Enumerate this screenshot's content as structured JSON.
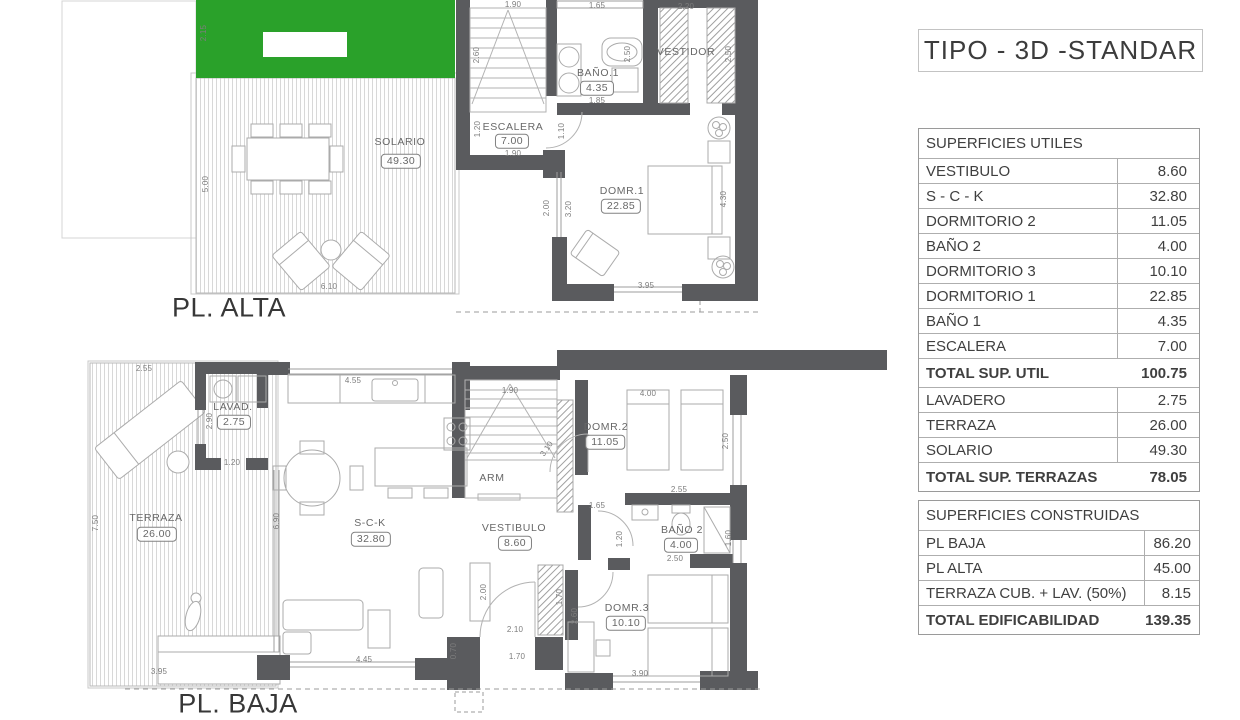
{
  "title": "TIPO - 3D -STANDAR",
  "plans": {
    "alta": {
      "annotations": [
        {
          "kind": "title",
          "text": "PL. ALTA",
          "x": 229,
          "y": 308
        },
        {
          "kind": "label",
          "text": "SOLARIO",
          "x": 400,
          "y": 142
        },
        {
          "kind": "box",
          "text": "49.30",
          "x": 401,
          "y": 161
        },
        {
          "kind": "label",
          "text": "ESCALERA",
          "x": 513,
          "y": 127
        },
        {
          "kind": "box",
          "text": "7.00",
          "x": 512,
          "y": 141
        },
        {
          "kind": "label",
          "text": "BAÑO.1",
          "x": 598,
          "y": 73
        },
        {
          "kind": "box",
          "text": "4.35",
          "x": 597,
          "y": 88
        },
        {
          "kind": "label",
          "text": "VESTIDOR",
          "x": 686,
          "y": 52
        },
        {
          "kind": "label",
          "text": "DOMR.1",
          "x": 622,
          "y": 191
        },
        {
          "kind": "box",
          "text": "22.85",
          "x": 621,
          "y": 206
        },
        {
          "kind": "dim",
          "text": "2.15",
          "x": 204,
          "y": 33,
          "rot": -90
        },
        {
          "kind": "dim",
          "text": "1.90",
          "x": 513,
          "y": 5
        },
        {
          "kind": "dim",
          "text": "1.65",
          "x": 597,
          "y": 6
        },
        {
          "kind": "dim",
          "text": "2.20",
          "x": 686,
          "y": 7
        },
        {
          "kind": "dim",
          "text": "2.60",
          "x": 477,
          "y": 55,
          "rot": -90
        },
        {
          "kind": "dim",
          "text": "2.50",
          "x": 628,
          "y": 54,
          "rot": -90
        },
        {
          "kind": "dim",
          "text": "2.50",
          "x": 729,
          "y": 54,
          "rot": -90
        },
        {
          "kind": "dim",
          "text": "1.85",
          "x": 597,
          "y": 101
        },
        {
          "kind": "dim",
          "text": "1.20",
          "x": 478,
          "y": 129,
          "rot": -90
        },
        {
          "kind": "dim",
          "text": "1.10",
          "x": 562,
          "y": 131,
          "rot": -90
        },
        {
          "kind": "dim",
          "text": "1.90",
          "x": 513,
          "y": 154
        },
        {
          "kind": "dim",
          "text": "5.00",
          "x": 206,
          "y": 184,
          "rot": -90
        },
        {
          "kind": "dim",
          "text": "2.00",
          "x": 547,
          "y": 208,
          "rot": -90
        },
        {
          "kind": "dim",
          "text": "3.20",
          "x": 569,
          "y": 209,
          "rot": -90
        },
        {
          "kind": "dim",
          "text": "4.30",
          "x": 724,
          "y": 199,
          "rot": -90
        },
        {
          "kind": "dim",
          "text": "3.95",
          "x": 646,
          "y": 286
        },
        {
          "kind": "dim",
          "text": "6.10",
          "x": 329,
          "y": 287
        }
      ]
    },
    "baja": {
      "annotations": [
        {
          "kind": "title",
          "text": "PL. BAJA",
          "x": 238,
          "y": 704
        },
        {
          "kind": "label",
          "text": "TERRAZA",
          "x": 156,
          "y": 518
        },
        {
          "kind": "box",
          "text": "26.00",
          "x": 157,
          "y": 534
        },
        {
          "kind": "label",
          "text": "LAVAD.",
          "x": 233,
          "y": 407
        },
        {
          "kind": "box",
          "text": "2.75",
          "x": 234,
          "y": 422
        },
        {
          "kind": "label",
          "text": "S-C-K",
          "x": 370,
          "y": 523
        },
        {
          "kind": "box",
          "text": "32.80",
          "x": 371,
          "y": 539
        },
        {
          "kind": "label",
          "text": "VESTIBULO",
          "x": 514,
          "y": 528
        },
        {
          "kind": "box",
          "text": "8.60",
          "x": 515,
          "y": 543
        },
        {
          "kind": "label",
          "text": "ARM",
          "x": 492,
          "y": 478
        },
        {
          "kind": "label",
          "text": "DOMR.2",
          "x": 606,
          "y": 427
        },
        {
          "kind": "box",
          "text": "11.05",
          "x": 605,
          "y": 442
        },
        {
          "kind": "label",
          "text": "BAÑO 2",
          "x": 682,
          "y": 530
        },
        {
          "kind": "box",
          "text": "4.00",
          "x": 681,
          "y": 545
        },
        {
          "kind": "label",
          "text": "DOMR.3",
          "x": 627,
          "y": 608
        },
        {
          "kind": "box",
          "text": "10.10",
          "x": 626,
          "y": 623
        },
        {
          "kind": "dim",
          "text": "2.55",
          "x": 144,
          "y": 369
        },
        {
          "kind": "dim",
          "text": "7.50",
          "x": 96,
          "y": 523,
          "rot": -90
        },
        {
          "kind": "dim",
          "text": "2.90",
          "x": 210,
          "y": 421,
          "rot": -90
        },
        {
          "kind": "dim",
          "text": "1.20",
          "x": 232,
          "y": 463
        },
        {
          "kind": "dim",
          "text": "4.55",
          "x": 353,
          "y": 381
        },
        {
          "kind": "dim",
          "text": "1.90",
          "x": 510,
          "y": 391
        },
        {
          "kind": "dim",
          "text": "3.10",
          "x": 547,
          "y": 449,
          "rot": -55
        },
        {
          "kind": "dim",
          "text": "6.90",
          "x": 277,
          "y": 521,
          "rot": -90
        },
        {
          "kind": "dim",
          "text": "4.00",
          "x": 648,
          "y": 394
        },
        {
          "kind": "dim",
          "text": "2.50",
          "x": 726,
          "y": 441,
          "rot": -90
        },
        {
          "kind": "dim",
          "text": "2.55",
          "x": 679,
          "y": 490
        },
        {
          "kind": "dim",
          "text": "1.65",
          "x": 597,
          "y": 506
        },
        {
          "kind": "dim",
          "text": "1.20",
          "x": 620,
          "y": 539,
          "rot": -90
        },
        {
          "kind": "dim",
          "text": "1.60",
          "x": 729,
          "y": 538,
          "rot": -90
        },
        {
          "kind": "dim",
          "text": "2.50",
          "x": 675,
          "y": 559
        },
        {
          "kind": "dim",
          "text": "2.60",
          "x": 575,
          "y": 616,
          "rot": -90
        },
        {
          "kind": "dim",
          "text": "1.70",
          "x": 560,
          "y": 597,
          "rot": -90
        },
        {
          "kind": "dim",
          "text": "3.90",
          "x": 640,
          "y": 674
        },
        {
          "kind": "dim",
          "text": "2.10",
          "x": 515,
          "y": 630
        },
        {
          "kind": "dim",
          "text": "1.70",
          "x": 517,
          "y": 657
        },
        {
          "kind": "dim",
          "text": "0.70",
          "x": 454,
          "y": 651,
          "rot": -90
        },
        {
          "kind": "dim",
          "text": "2.00",
          "x": 484,
          "y": 592,
          "rot": -90
        },
        {
          "kind": "dim",
          "text": "4.45",
          "x": 364,
          "y": 660
        },
        {
          "kind": "dim",
          "text": "3.95",
          "x": 159,
          "y": 672
        }
      ]
    }
  },
  "tables": {
    "utiles": {
      "rows": [
        {
          "type": "header",
          "label": "SUPERFICIES UTILES",
          "value": ""
        },
        {
          "type": "item",
          "label": "VESTIBULO",
          "value": "8.60"
        },
        {
          "type": "item",
          "label": "S - C - K",
          "value": "32.80"
        },
        {
          "type": "item",
          "label": "DORMITORIO 2",
          "value": "11.05"
        },
        {
          "type": "item",
          "label": "BAÑO 2",
          "value": "4.00"
        },
        {
          "type": "item",
          "label": "DORMITORIO 3",
          "value": "10.10"
        },
        {
          "type": "item",
          "label": "DORMITORIO 1",
          "value": "22.85"
        },
        {
          "type": "item",
          "label": "BAÑO 1",
          "value": "4.35"
        },
        {
          "type": "item",
          "label": "ESCALERA",
          "value": "7.00"
        },
        {
          "type": "total",
          "label": "TOTAL SUP. UTIL",
          "value": "100.75"
        },
        {
          "type": "item",
          "label": "LAVADERO",
          "value": "2.75"
        },
        {
          "type": "item",
          "label": "TERRAZA",
          "value": "26.00"
        },
        {
          "type": "item",
          "label": "SOLARIO",
          "value": "49.30"
        },
        {
          "type": "total",
          "label": "TOTAL SUP. TERRAZAS",
          "value": "78.05"
        }
      ]
    },
    "construidas": {
      "rows": [
        {
          "type": "header",
          "label": "SUPERFICIES CONSTRUIDAS",
          "value": ""
        },
        {
          "type": "item",
          "label": "PL BAJA",
          "value": "86.20"
        },
        {
          "type": "item",
          "label": "PL ALTA",
          "value": "45.00"
        },
        {
          "type": "item",
          "label": "TERRAZA CUB. + LAV. (50%)",
          "value": "8.15"
        },
        {
          "type": "total",
          "label": "TOTAL EDIFICABILIDAD",
          "value": "139.35"
        }
      ]
    }
  },
  "colors": {
    "wall": "#5a5b5e",
    "grass": "#2aa12a",
    "accent_line": "#ababab"
  }
}
